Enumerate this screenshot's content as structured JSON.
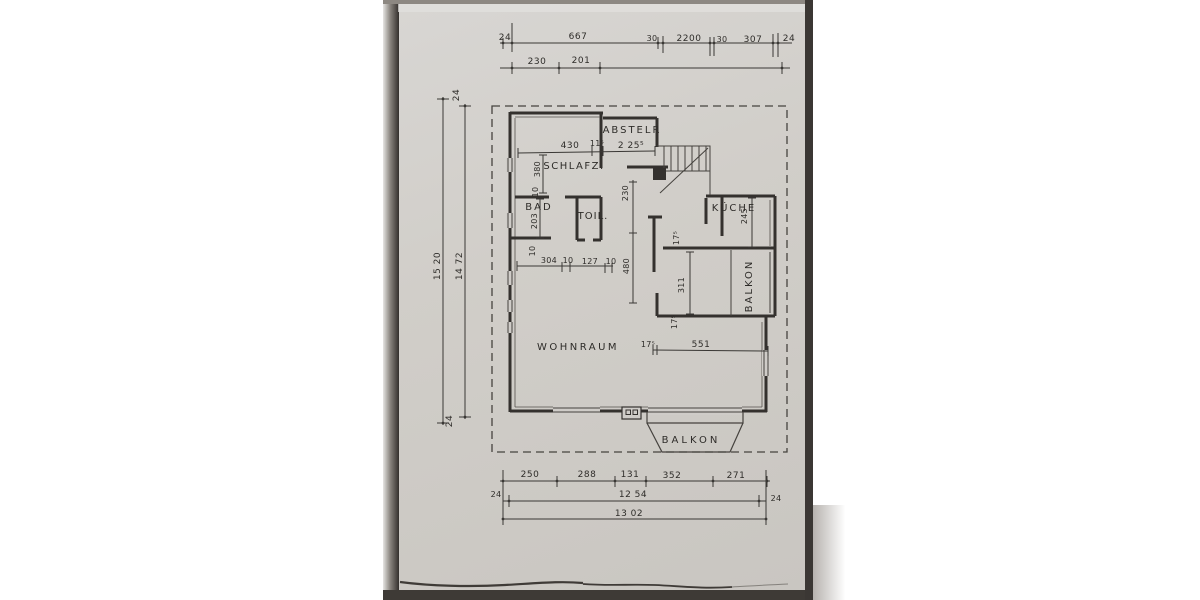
{
  "rooms": {
    "abstellraum": "ABSTELR",
    "schlafzimmer": "SCHLAFZ.",
    "bad": "BAD",
    "toilette": "TOIL.",
    "kueche": "KÜCHE",
    "balkon_right": "BALKON",
    "wohnraum": "WOHNRAUM",
    "balkon_bottom": "BALKON"
  },
  "dimensions": {
    "top_row1": {
      "left_24": "24",
      "d667": "667",
      "d30a": "30",
      "d2200": "2200",
      "d30b": "30",
      "d307": "307",
      "right_24": "24"
    },
    "top_row2": {
      "d230": "230",
      "d201": "201"
    },
    "left_col": {
      "top_24": "24",
      "d1520": "15 20",
      "d1472": "14 72",
      "bottom_24": "24"
    },
    "interior": {
      "d430": "430",
      "d115": "11⁵",
      "d2255": "2 25⁵",
      "d380": "380",
      "d10_a": "10",
      "d203": "203",
      "d10_b": "10",
      "d230v": "230",
      "d480": "480",
      "d304": "304",
      "d10_c": "10",
      "d127": "127",
      "d10_d": "10",
      "d175_a": "17⁵",
      "d245": "245",
      "d311": "311",
      "d175_b": "17⁵",
      "d175_c": "17⁵",
      "d551": "551"
    },
    "bottom_row1": {
      "d250": "250",
      "d288": "288",
      "d131": "131",
      "d352": "352",
      "d271": "271"
    },
    "bottom_row2": {
      "left_24": "24",
      "d1254": "12 54",
      "right_24": "24"
    },
    "bottom_row3": {
      "d1302": "13 02"
    }
  },
  "colors": {
    "paper": "#d1cec9",
    "ink": "#2f2d2a",
    "photo_edge": "#3b3734"
  }
}
